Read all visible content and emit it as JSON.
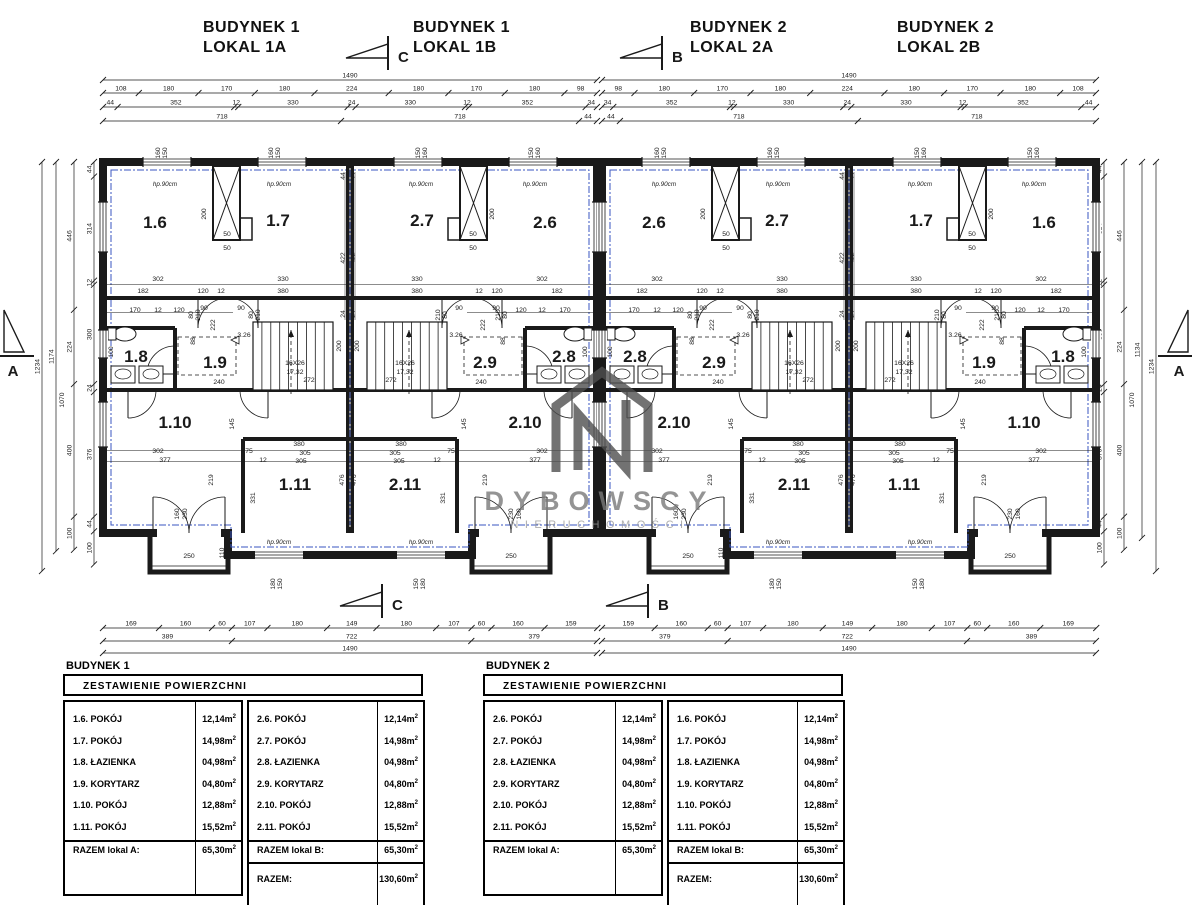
{
  "palette": {
    "line": "#1a1a1a",
    "blue": "#3a55c0",
    "watermark_dark": "#4f4f4f",
    "watermark_mid": "#7a7a7a",
    "watermark_light": "#9a9a9a"
  },
  "titles": [
    {
      "line1": "BUDYNEK 1",
      "line2": "LOKAL 1A",
      "x": 203,
      "y": 18
    },
    {
      "line1": "BUDYNEK 1",
      "line2": "LOKAL 1B",
      "x": 413,
      "y": 18
    },
    {
      "line1": "BUDYNEK 2",
      "line2": "LOKAL 2A",
      "x": 690,
      "y": 18
    },
    {
      "line1": "BUDYNEK 2",
      "line2": "LOKAL 2B",
      "x": 897,
      "y": 18
    }
  ],
  "markers": {
    "top": [
      {
        "letter": "C",
        "x": 346,
        "y": 36
      },
      {
        "letter": "B",
        "x": 620,
        "y": 36
      }
    ],
    "bottom": [
      {
        "letter": "C",
        "x": 340,
        "y": 584
      },
      {
        "letter": "B",
        "x": 606,
        "y": 584
      }
    ],
    "left": {
      "letter": "A",
      "x": 2,
      "y": 302
    },
    "right": {
      "letter": "A",
      "x": 1160,
      "y": 302
    }
  },
  "watermark": {
    "brand": "DYBOWSCY",
    "sub": "NIERUCHOMOŚCI"
  },
  "plan": {
    "buildings": [
      {
        "x0": 103
      },
      {
        "x0": 602
      }
    ],
    "y0": 162,
    "unit_w": 247,
    "height": 371,
    "units": [
      {
        "x0": 103,
        "mirror": false,
        "rooms": {
          "a": "1.6",
          "b": "1.7",
          "bath": "1.8",
          "cor": "1.9",
          "c": "1.10",
          "d": "1.11"
        }
      },
      {
        "x0": 350,
        "mirror": true,
        "rooms": {
          "a": "2.6",
          "b": "2.7",
          "bath": "2.8",
          "cor": "2.9",
          "c": "2.10",
          "d": "2.11"
        }
      },
      {
        "x0": 602,
        "mirror": false,
        "rooms": {
          "a": "2.6",
          "b": "2.7",
          "bath": "2.8",
          "cor": "2.9",
          "c": "2.10",
          "d": "2.11"
        }
      },
      {
        "x0": 849,
        "mirror": true,
        "rooms": {
          "a": "1.6",
          "b": "1.7",
          "bath": "1.8",
          "cor": "1.9",
          "c": "1.10",
          "d": "1.11"
        }
      }
    ],
    "room_slots": {
      "a": [
        52,
        66
      ],
      "b": [
        175,
        64
      ],
      "bath": [
        33,
        200
      ],
      "cor": [
        112,
        206
      ],
      "c": [
        72,
        266
      ],
      "d": [
        192,
        328
      ]
    },
    "dim_labels": [
      {
        "t": "hp.90cm",
        "x": 62,
        "y": 24,
        "i": 1
      },
      {
        "t": "hp.90cm",
        "x": 176,
        "y": 24,
        "i": 1
      },
      {
        "t": "160",
        "x": 57,
        "y": -9,
        "r": 1
      },
      {
        "t": "150",
        "x": 64,
        "y": -9,
        "r": 1
      },
      {
        "t": "160",
        "x": 170,
        "y": -9,
        "r": 1
      },
      {
        "t": "150",
        "x": 177,
        "y": -9,
        "r": 1
      },
      {
        "t": "200",
        "x": 103,
        "y": 52,
        "r": 1
      },
      {
        "t": "50",
        "x": 124,
        "y": 74
      },
      {
        "t": "50",
        "x": 124,
        "y": 88
      },
      {
        "t": "302",
        "x": 55,
        "y": 119
      },
      {
        "t": "182",
        "x": 40,
        "y": 131
      },
      {
        "t": "120",
        "x": 100,
        "y": 131
      },
      {
        "t": "12",
        "x": 118,
        "y": 131
      },
      {
        "t": "330",
        "x": 180,
        "y": 119
      },
      {
        "t": "380",
        "x": 180,
        "y": 131
      },
      {
        "t": "44",
        "x": 242,
        "y": 14,
        "r": 1
      },
      {
        "t": "422",
        "x": 242,
        "y": 96,
        "r": 1
      },
      {
        "t": "24",
        "x": 242,
        "y": 152,
        "r": 1
      },
      {
        "t": "170",
        "x": 32,
        "y": 150
      },
      {
        "t": "12",
        "x": 55,
        "y": 150
      },
      {
        "t": "120",
        "x": 76,
        "y": 150
      },
      {
        "t": "222",
        "x": 112,
        "y": 163,
        "r": 1
      },
      {
        "t": "88",
        "x": 92,
        "y": 179,
        "r": 1
      },
      {
        "t": "90",
        "x": 101,
        "y": 148
      },
      {
        "t": "90",
        "x": 138,
        "y": 148
      },
      {
        "t": "80",
        "x": 90,
        "y": 153,
        "r": 1
      },
      {
        "t": "210",
        "x": 97,
        "y": 153,
        "r": 1
      },
      {
        "t": "80",
        "x": 150,
        "y": 153,
        "r": 1
      },
      {
        "t": "210",
        "x": 157,
        "y": 153,
        "r": 1
      },
      {
        "t": "3.26",
        "x": 141,
        "y": 175
      },
      {
        "t": "240",
        "x": 116,
        "y": 222
      },
      {
        "t": "16X26",
        "x": 192,
        "y": 203
      },
      {
        "t": "17,32",
        "x": 192,
        "y": 212
      },
      {
        "t": "272",
        "x": 206,
        "y": 220
      },
      {
        "t": "200",
        "x": 238,
        "y": 184,
        "r": 1
      },
      {
        "t": "100",
        "x": 10,
        "y": 190,
        "r": 1
      },
      {
        "t": "302",
        "x": 55,
        "y": 291
      },
      {
        "t": "377",
        "x": 62,
        "y": 300
      },
      {
        "t": "75",
        "x": 146,
        "y": 291
      },
      {
        "t": "12",
        "x": 160,
        "y": 300
      },
      {
        "t": "380",
        "x": 196,
        "y": 284
      },
      {
        "t": "305",
        "x": 202,
        "y": 293
      },
      {
        "t": "305",
        "x": 198,
        "y": 301
      },
      {
        "t": "219",
        "x": 110,
        "y": 318,
        "r": 1
      },
      {
        "t": "331",
        "x": 152,
        "y": 336,
        "r": 1
      },
      {
        "t": "476",
        "x": 241,
        "y": 318,
        "r": 1
      },
      {
        "t": "145",
        "x": 131,
        "y": 262,
        "r": 1
      },
      {
        "t": "160",
        "x": 76,
        "y": 352,
        "r": 1
      },
      {
        "t": "230",
        "x": 84,
        "y": 352,
        "r": 1
      },
      {
        "t": "110",
        "x": 121,
        "y": 391,
        "r": 1
      },
      {
        "t": "250",
        "x": 86,
        "y": 396
      },
      {
        "t": "hp.90cm",
        "x": 176,
        "y": 382,
        "i": 1
      },
      {
        "t": "180",
        "x": 172,
        "y": 422,
        "r": 1
      },
      {
        "t": "150",
        "x": 179,
        "y": 422,
        "r": 1
      }
    ]
  },
  "chains": {
    "scale": 0.3315,
    "top": [
      {
        "y": 80,
        "segs": [
          [
            "1490",
            1490
          ]
        ]
      },
      {
        "y": 93,
        "segs": [
          [
            "108",
            108
          ],
          [
            "180",
            180
          ],
          [
            "170",
            170
          ],
          [
            "180",
            180
          ],
          [
            "224",
            224
          ],
          [
            "180",
            180
          ],
          [
            "170",
            170
          ],
          [
            "180",
            180
          ],
          [
            "98",
            98
          ]
        ]
      },
      {
        "y": 107,
        "segs": [
          [
            "44",
            44
          ],
          [
            "352",
            352
          ],
          [
            "12",
            12
          ],
          [
            "330",
            330
          ],
          [
            "24",
            24
          ],
          [
            "330",
            330
          ],
          [
            "12",
            12
          ],
          [
            "352",
            352
          ],
          [
            "34",
            34
          ]
        ]
      },
      {
        "y": 121,
        "segs": [
          [
            "718",
            718
          ],
          [
            "718",
            718
          ],
          [
            "44",
            54
          ]
        ]
      }
    ],
    "bottom": [
      {
        "y": 628,
        "segs": [
          [
            "169",
            169
          ],
          [
            "160",
            160
          ],
          [
            "60",
            60
          ],
          [
            "107",
            107
          ],
          [
            "180",
            180
          ],
          [
            "149",
            149
          ],
          [
            "180",
            180
          ],
          [
            "107",
            107
          ],
          [
            "60",
            60
          ],
          [
            "160",
            160
          ],
          [
            "159",
            159
          ]
        ]
      },
      {
        "y": 641,
        "segs": [
          [
            "389",
            389
          ],
          [
            "722",
            722
          ],
          [
            "379",
            379
          ]
        ]
      },
      {
        "y": 653,
        "segs": [
          [
            "1490",
            1490
          ]
        ]
      }
    ],
    "left": [
      {
        "x": 94,
        "segs": [
          [
            "44",
            44
          ],
          [
            "314",
            314
          ],
          [
            "12",
            12
          ],
          [
            "300",
            300
          ],
          [
            "24",
            24
          ],
          [
            "376",
            376
          ],
          [
            "44",
            44
          ],
          [
            "100",
            100
          ]
        ]
      },
      {
        "x": 74,
        "segs": [
          [
            "446",
            446
          ],
          [
            "224",
            224
          ],
          [
            "400",
            400
          ],
          [
            "100",
            100
          ]
        ]
      },
      {
        "x": 56,
        "segs": [
          [
            "1174",
            1174
          ]
        ]
      },
      {
        "x": 42,
        "segs": [
          [
            "1234",
            1234
          ]
        ]
      }
    ],
    "right": [
      {
        "x": 1104,
        "segs": [
          [
            "44",
            44
          ],
          [
            "314",
            314
          ],
          [
            "12",
            12
          ],
          [
            "300",
            300
          ],
          [
            "24",
            24
          ],
          [
            "376",
            376
          ],
          [
            "44",
            44
          ],
          [
            "100",
            100
          ]
        ]
      },
      {
        "x": 1124,
        "segs": [
          [
            "446",
            446
          ],
          [
            "224",
            224
          ],
          [
            "400",
            400
          ],
          [
            "100",
            100
          ]
        ]
      },
      {
        "x": 1142,
        "segs": [
          [
            "1134",
            1134
          ]
        ]
      },
      {
        "x": 1156,
        "segs": [
          [
            "1234",
            1234
          ]
        ]
      }
    ],
    "extra": [
      {
        "t": "1070",
        "x": 64,
        "y": 400,
        "r": 1
      },
      {
        "t": "1070",
        "x": 1134,
        "y": 400,
        "r": 1
      }
    ]
  },
  "tables": [
    {
      "x": 63,
      "y": 660,
      "building": "BUDYNEK 1",
      "header": "ZESTAWIENIE POWIERZCHNI",
      "colA": {
        "rows": [
          [
            "1.6. POKÓJ",
            "12,14m"
          ],
          [
            "1.7. POKÓJ",
            "14,98m"
          ],
          [
            "1.8. ŁAZIENKA",
            "04,98m"
          ],
          [
            "1.9. KORYTARZ",
            "04,80m"
          ],
          [
            "1.10. POKÓJ",
            "12,88m"
          ],
          [
            "1.11. POKÓJ",
            "15,52m"
          ]
        ],
        "total_label": "RAZEM lokal A:",
        "total_value": "65,30m"
      },
      "colB": {
        "rows": [
          [
            "2.6. POKÓJ",
            "12,14m"
          ],
          [
            "2.7. POKÓJ",
            "14,98m"
          ],
          [
            "2.8. ŁAZIENKA",
            "04,98m"
          ],
          [
            "2.9. KORYTARZ",
            "04,80m"
          ],
          [
            "2.10. POKÓJ",
            "12,88m"
          ],
          [
            "2.11. POKÓJ",
            "15,52m"
          ]
        ],
        "total_label": "RAZEM lokal B:",
        "total_value": "65,30m",
        "grand_label": "RAZEM:",
        "grand_value": "130,60m"
      }
    },
    {
      "x": 483,
      "y": 660,
      "building": "BUDYNEK 2",
      "header": "ZESTAWIENIE POWIERZCHNI",
      "colA": {
        "rows": [
          [
            "2.6. POKÓJ",
            "12,14m"
          ],
          [
            "2.7. POKÓJ",
            "14,98m"
          ],
          [
            "2.8. ŁAZIENKA",
            "04,98m"
          ],
          [
            "2.9. KORYTARZ",
            "04,80m"
          ],
          [
            "2.10. POKÓJ",
            "12,88m"
          ],
          [
            "2.11. POKÓJ",
            "15,52m"
          ]
        ],
        "total_label": "RAZEM lokal A:",
        "total_value": "65,30m"
      },
      "colB": {
        "rows": [
          [
            "1.6. POKÓJ",
            "12,14m"
          ],
          [
            "1.7. POKÓJ",
            "14,98m"
          ],
          [
            "1.8. ŁAZIENKA",
            "04,98m"
          ],
          [
            "1.9. KORYTARZ",
            "04,80m"
          ],
          [
            "1.10. POKÓJ",
            "12,88m"
          ],
          [
            "1.11. POKÓJ",
            "15,52m"
          ]
        ],
        "total_label": "RAZEM lokal B:",
        "total_value": "65,30m",
        "grand_label": "RAZEM:",
        "grand_value": "130,60m"
      }
    }
  ],
  "sup": "2"
}
